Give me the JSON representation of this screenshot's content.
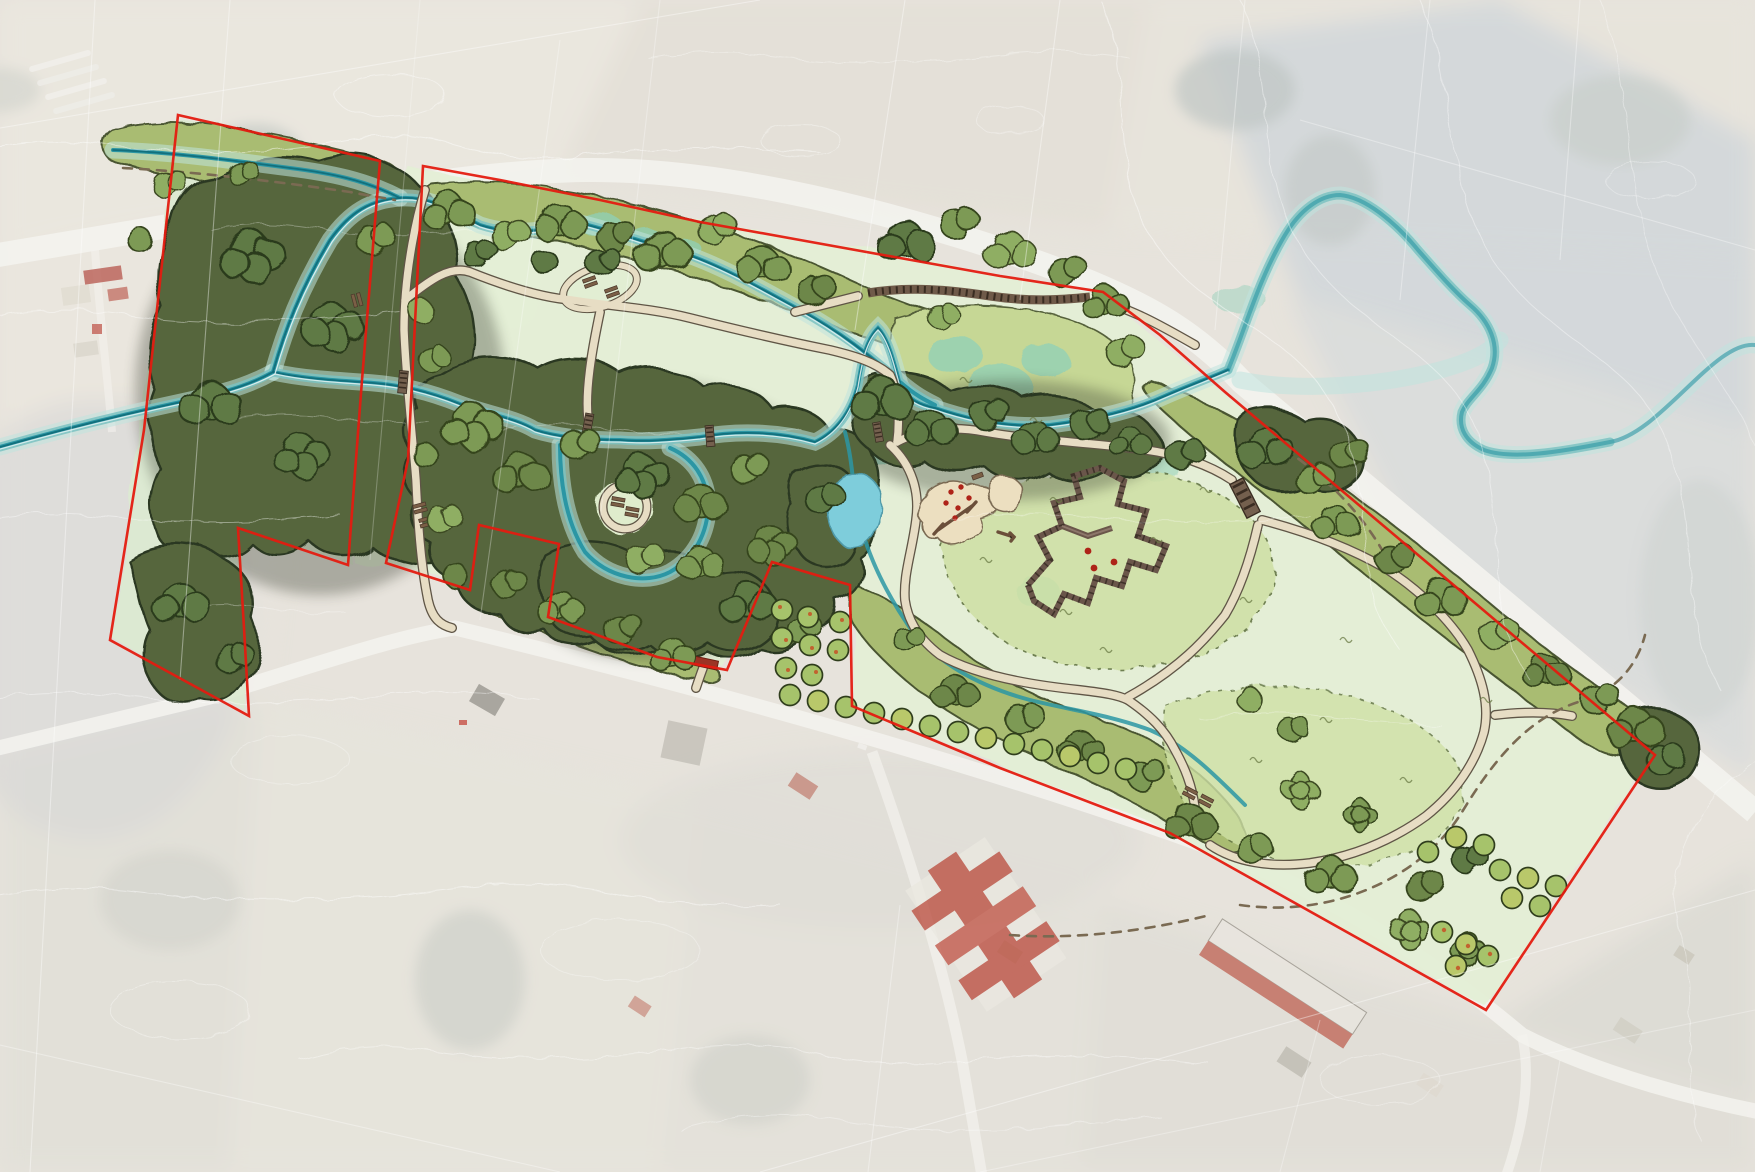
{
  "document": {
    "title": "Park landscape masterplan over aerial photograph",
    "type": "site masterplan map",
    "canvas_px": {
      "width": 1755,
      "height": 1172
    },
    "text_labels": []
  },
  "colors": {
    "aerial_base": "#d7d1c5",
    "aerial_shadow": "#aab4ba",
    "road_grey": "#eceae3",
    "contour_white": "#ffffff",
    "boundary_red": "#e41b10",
    "river_teal": "#2b96a4",
    "river_core": "#106b79",
    "river_halo": "#7cc2c2",
    "water_wash": "#bfe3de",
    "wetland_aqua": "#8fd0b8",
    "pond_blue": "#7ecddb",
    "forest_dark": "#57663d",
    "forest_outline": "#2c3720",
    "canopy_mid": "#7d9a55",
    "canopy_light": "#8fae63",
    "scrub_green": "#a9bc72",
    "marsh_green": "#c6d795",
    "lawn_light": "#e3efd5",
    "meadow_inner": "#cfe0a5",
    "path_tan": "#e7ddc4",
    "path_edge": "#5f5546",
    "boardwalk_brown": "#6f5a49",
    "earthwork_brown": "#6a564a",
    "sand_tan": "#ecdfc0",
    "orchard_green": "#a6c36b",
    "orchard_accent": "#c2622f",
    "roof_red": "#bd6a5d",
    "building_white": "#eae7e0",
    "marker_red": "#ae2318"
  },
  "features": [
    {
      "name": "site-boundary",
      "kind": "boundary-line",
      "color_ref": "boundary_red"
    },
    {
      "name": "river-channel",
      "kind": "watercourse",
      "color_ref": "river_teal"
    },
    {
      "name": "stream-corridor-wash",
      "kind": "watercourse-buffer",
      "color_ref": "water_wash"
    },
    {
      "name": "wetland-pools",
      "kind": "water",
      "color_ref": "wetland_aqua"
    },
    {
      "name": "pond",
      "kind": "water",
      "color_ref": "pond_blue"
    },
    {
      "name": "native-forest-canopy",
      "kind": "vegetation",
      "color_ref": "forest_dark"
    },
    {
      "name": "tree-canopy-cluster",
      "kind": "vegetation",
      "color_ref": "canopy_mid"
    },
    {
      "name": "scrub-revegetation",
      "kind": "vegetation",
      "color_ref": "scrub_green"
    },
    {
      "name": "open-lawn",
      "kind": "grass",
      "color_ref": "lawn_light"
    },
    {
      "name": "meadow-grassland",
      "kind": "grass",
      "color_ref": "meadow_inner"
    },
    {
      "name": "gravel-path",
      "kind": "circulation",
      "color_ref": "path_tan"
    },
    {
      "name": "mown-trail",
      "kind": "circulation-dashed",
      "color_ref": "path_edge"
    },
    {
      "name": "boardwalk",
      "kind": "structure",
      "color_ref": "boardwalk_brown"
    },
    {
      "name": "footbridge",
      "kind": "structure",
      "color_ref": "boardwalk_brown"
    },
    {
      "name": "earthwork-maze",
      "kind": "structure",
      "color_ref": "earthwork_brown"
    },
    {
      "name": "playground",
      "kind": "recreation",
      "color_ref": "sand_tan"
    },
    {
      "name": "orchard-tree",
      "kind": "vegetation",
      "color_ref": "orchard_green"
    },
    {
      "name": "existing-road",
      "kind": "road",
      "color_ref": "road_grey"
    },
    {
      "name": "existing-building",
      "kind": "building",
      "color_ref": "roof_red"
    },
    {
      "name": "contour-line",
      "kind": "terrain",
      "color_ref": "contour_white"
    },
    {
      "name": "cadastral-line",
      "kind": "parcel-line",
      "color_ref": "contour_white"
    },
    {
      "name": "aerial-photo-base",
      "kind": "basemap",
      "color_ref": "aerial_base"
    }
  ]
}
